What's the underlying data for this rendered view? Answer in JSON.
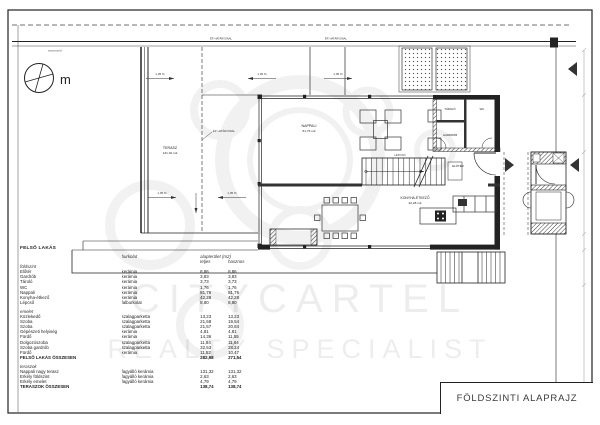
{
  "sheet": {
    "title": "FÖLDSZINTI ALAPRAJZ"
  },
  "compass": {
    "label": "m"
  },
  "watermark": {
    "line1": "CITYCARTEL",
    "line2": "REALTY SPECIALIST"
  },
  "plan": {
    "slope_label": "1,05 %",
    "boundary_label": "ÉP. HATÁRVONAL",
    "neighbor_label": "szomszéd",
    "rooms": {
      "terasz": {
        "name": "TERASZ",
        "area": "131,32 m2"
      },
      "nappali": {
        "name": "NAPPALI",
        "area": "81,76 m2"
      },
      "konyha": {
        "name": "KONYHA-ÉTKEZŐ",
        "area": "42,28 m2"
      },
      "eloter": {
        "name": "ELŐTÉR"
      },
      "gardrob": {
        "name": "GARDRÓB"
      },
      "tarolo": {
        "name": "TÁROLÓ"
      },
      "wc": {
        "name": "WC"
      },
      "lepcso": {
        "name": "LÉPCSŐ"
      }
    }
  },
  "table": {
    "title": "FELSŐ LAKÁS",
    "headers": {
      "material": "burkolat",
      "area": "alapterület (m2)",
      "total": "teljes",
      "useful": "hasznos"
    },
    "groups": [
      {
        "name": "földszint",
        "rows": [
          [
            "Előtér",
            "kerámia",
            "8,86",
            "8,86"
          ],
          [
            "Gardrób",
            "kerámia",
            "3,83",
            "3,83"
          ],
          [
            "Tároló",
            "kerámia",
            "3,73",
            "3,73"
          ],
          [
            "WC",
            "kerámia",
            "1,76",
            "1,76"
          ],
          [
            "Nappali",
            "kerámia",
            "81,76",
            "81,76"
          ],
          [
            "Konyha-étkező",
            "kerámia",
            "42,28",
            "42,28"
          ],
          [
            "Lépcső",
            "falburkolat",
            "8,80",
            "8,80"
          ]
        ]
      },
      {
        "name": "emelet",
        "rows": [
          [
            "Közlekedő",
            "szalagparketta",
            "13,23",
            "13,23"
          ],
          [
            "Szoba",
            "szalagparketta",
            "21,68",
            "19,54"
          ],
          [
            "Szoba",
            "szalagparketta",
            "21,57",
            "20,84"
          ],
          [
            "Gépészeti helyiség",
            "kerámia",
            "4,81",
            "4,81"
          ],
          [
            "Fürdő",
            "kerámia",
            "14,36",
            "11,55"
          ],
          [
            "Dolgozószoba",
            "szalagparketta",
            "11,84",
            "11,84"
          ],
          [
            "Szoba gardrób",
            "szalagparketta",
            "32,53",
            "28,24"
          ],
          [
            "Fürdő",
            "kerámia",
            "11,52",
            "10,47"
          ]
        ],
        "total": [
          "FELSŐ LAKÁS ÖSSZESEN",
          "282,98",
          "271,54"
        ]
      },
      {
        "name": "teraszok",
        "rows": [
          [
            "Nappali nagy terasz",
            "fagyálló kerámia",
            "131,32",
            "131,32"
          ],
          [
            "Erkély földszint",
            "fagyálló kerámia",
            "2,63",
            "2,63"
          ],
          [
            "Erkély emelet",
            "fagyálló kerámia",
            "4,79",
            "4,79"
          ]
        ],
        "total": [
          "TERASZOK ÖSSZESEN",
          "138,74",
          "138,74"
        ]
      }
    ]
  }
}
